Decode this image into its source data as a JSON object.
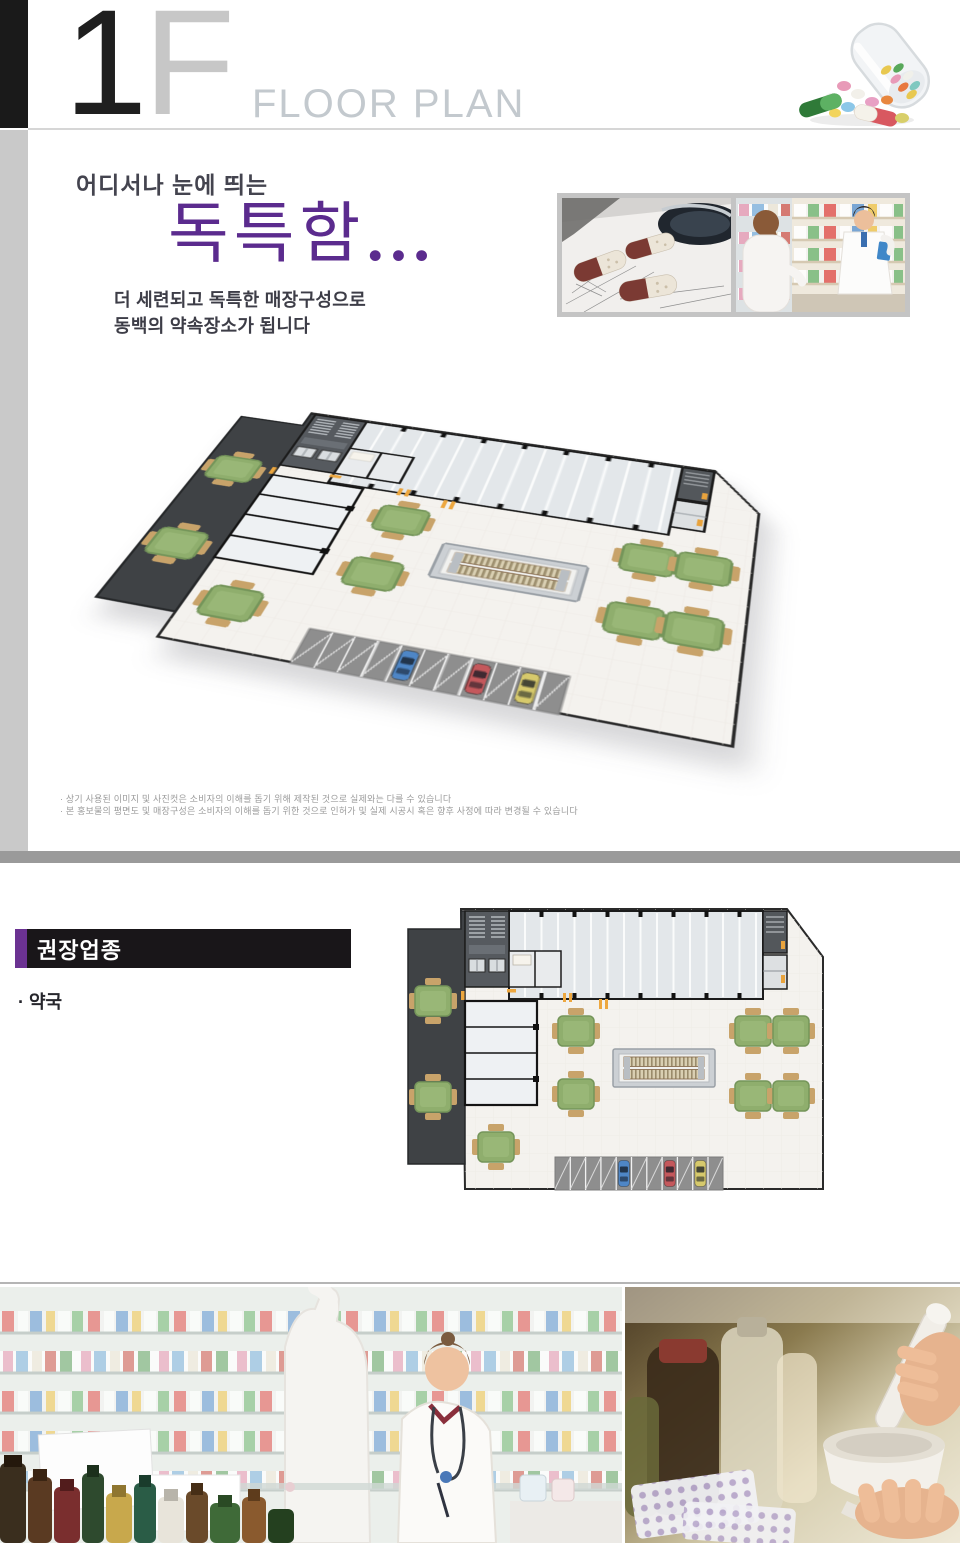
{
  "header": {
    "floor_big": "1",
    "floor_letter": "F",
    "subtitle": "FLOOR PLAN"
  },
  "hero": {
    "eyebrow": "어디서나 눈에 띄는",
    "headline": "독특함",
    "ellipsis": "...",
    "desc1": "더 세련되고 독특한 매장구성으로",
    "desc2": "동백의 약속장소가 됩니다"
  },
  "disclaimers": {
    "line1": "· 상기 사용된 이미지 및 사진컷은 소비자의 이해를 돕기 위해 제작된 것으로 실제와는 다를 수 있습니다",
    "line2": "· 본 홍보물의 평면도 및 매장구성은 소비자의 이해를 돕기 위한 것으로 인허가 및 실제 시공시 혹은 향후 사정에 따라 변경될 수 있습니다"
  },
  "recommended": {
    "title": "권장업종",
    "item1": "· 약국"
  },
  "colors": {
    "accent_purple": "#6b3292",
    "headline_purple": "#5b2b8e",
    "divider_gray": "#9a9a9a",
    "plan_dark_area": "#3f4245",
    "plan_floor_cream": "#f4f2ee",
    "plan_parking_gray": "#8e8e8e",
    "table_green": "#8fae6d",
    "car_blue": "#4e86c6",
    "car_red": "#c4585c",
    "car_yellow": "#d6c96c"
  }
}
